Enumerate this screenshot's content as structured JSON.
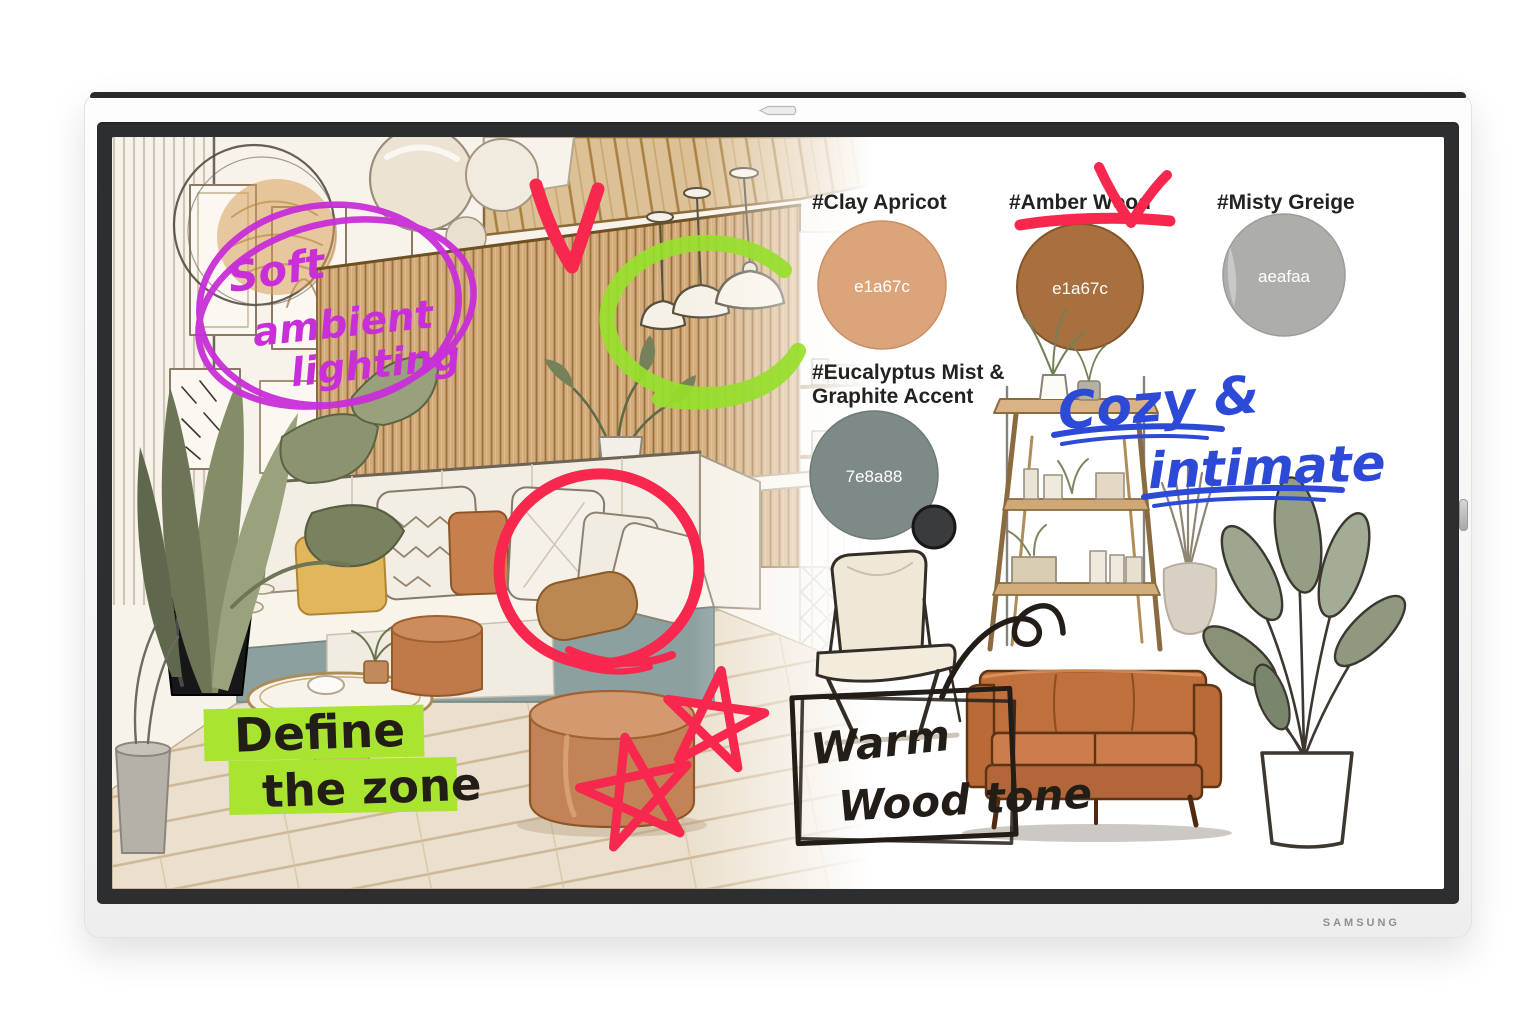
{
  "device": {
    "brand_logo": "SAMSUNG"
  },
  "colors": {
    "red_marker": "#f7274e",
    "green_marker": "#97e02c",
    "green_highlight": "#a9e431",
    "magenta_marker": "#c92fd8",
    "blue_marker": "#2d4ad6",
    "ink": "#231d17"
  },
  "swatches": [
    {
      "name": "clay-apricot",
      "label": "#Clay Apricot",
      "hex": "e1a67c",
      "fill": "#dca47b"
    },
    {
      "name": "amber-wood",
      "label": "#Amber Wood",
      "hex": "e1a67c",
      "fill": "#a7703e"
    },
    {
      "name": "misty-greige",
      "label": "#Misty Greige",
      "hex": "aeafaa",
      "fill": "#adaea9"
    },
    {
      "name": "eucalyptus-graphite",
      "label_line1": "#Eucalyptus Mist &",
      "label_line2": "Graphite Accent",
      "hex": "7e8a88",
      "fill": "#7e8a88",
      "accent_fill": "#3a3b3c"
    }
  ],
  "annotations": {
    "soft_ambient_lighting": {
      "line1": "Soft",
      "line2": "ambient",
      "line3": "lighting"
    },
    "cozy_intimate": {
      "line1": "Cozy &",
      "line2": "intimate"
    },
    "define_the_zone": {
      "line1": "Define",
      "line2": "the zone"
    },
    "warm_wood_tone": {
      "line1": "Warm",
      "line2": "Wood tone"
    }
  }
}
